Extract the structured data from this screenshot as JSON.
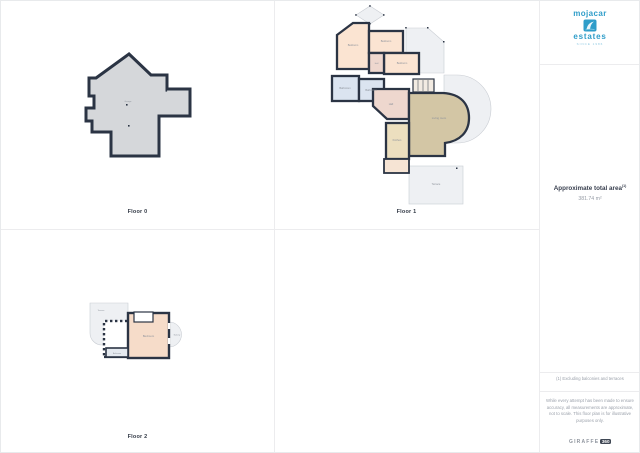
{
  "logo": {
    "name": "mojacar",
    "sub": "estates",
    "tagline": "since 1986",
    "icon": "wave-icon",
    "color": "#2f9dc9"
  },
  "floors": {
    "floor0": {
      "label": "Floor 0",
      "rooms": {
        "garage": "Garage"
      }
    },
    "floor1": {
      "label": "Floor 1",
      "rooms": {
        "bedroom1": "Bedroom",
        "bedroom2": "Bedroom",
        "bedroom3": "Bedroom",
        "hall_small": "Hall",
        "bathroom1": "Bathroom",
        "bathroom2": "Bathroom",
        "hall": "Hall",
        "living": "Living room",
        "kitchen": "Kitchen",
        "terrace": "Terrace"
      }
    },
    "floor2": {
      "label": "Floor 2",
      "rooms": {
        "terrace": "Terrace",
        "bedroom": "Bedroom",
        "bathroom": "Bathroom",
        "balcony": "Balcony"
      }
    }
  },
  "sidebar": {
    "area_title": "Approximate total area",
    "area_marker": "(1)",
    "area_value": "381.74 m²",
    "footnote": "(1) Excluding balconies and terraces",
    "disclaimer": "While every attempt has been made to ensure accuracy, all measurements are approximate, not to scale. This floor plan is for illustrative purposes only.",
    "brand_text": "GIRAFFE",
    "brand_badge": "360"
  },
  "colors": {
    "wall": "#2b3444",
    "floor0_fill": "#d5d7da",
    "bedroom_fill": "#fbe4d2",
    "bathroom_fill": "#dbe4f0",
    "hall_fill": "#eed7ce",
    "living_fill": "#d3c6a5",
    "kitchen_fill": "#ecdfbf",
    "terrace_fill": "#eef0f3",
    "divider": "#ececee"
  }
}
